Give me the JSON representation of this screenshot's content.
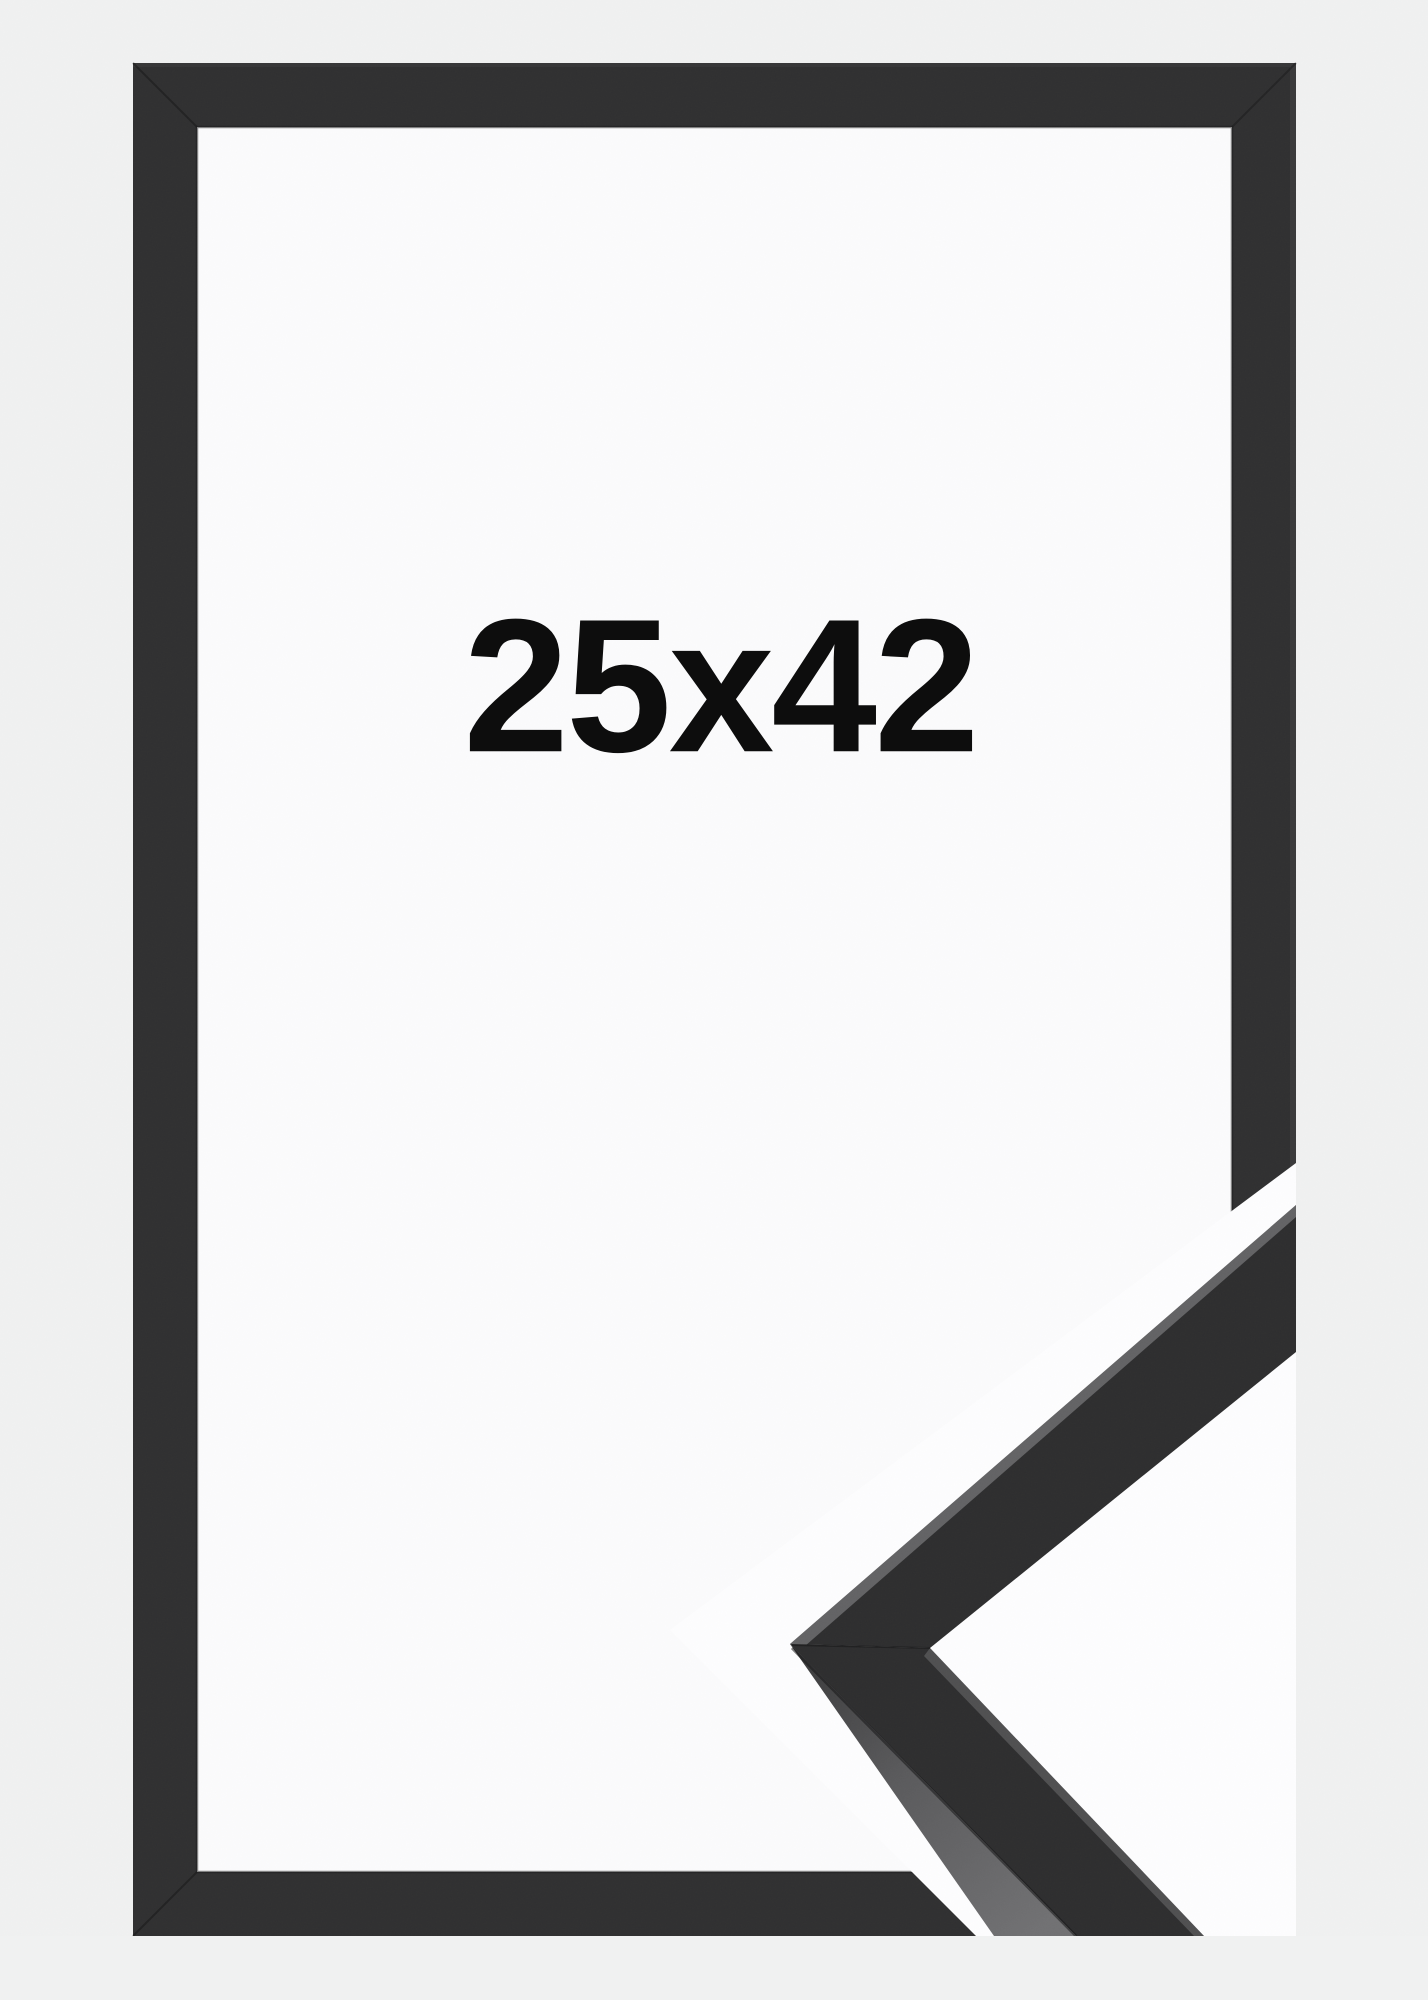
{
  "product": {
    "size_label": "25x42"
  },
  "colors": {
    "background": "#f0f1f1",
    "frame_moulding": "#303031",
    "frame_opening": "#fbfbfc",
    "label_text": "#0d0d0d",
    "cutout_white": "#fdfdfe",
    "sample_face_dark": "#2e2e2f",
    "sample_side_gray": "#606062",
    "sample_edge_highlight": "#909092"
  }
}
